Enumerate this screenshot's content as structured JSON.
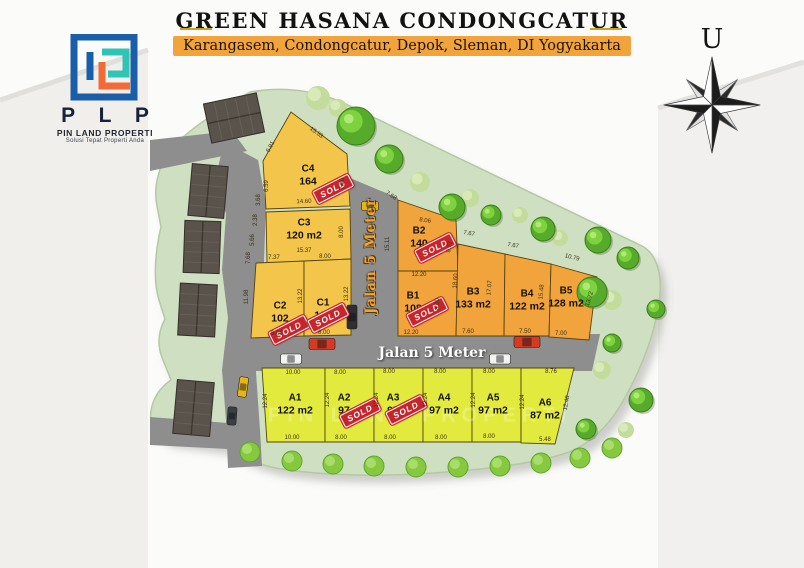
{
  "header": {
    "title": "GREEN HASANA CONDONGCATUR",
    "subtitle": "Karangasem, Condongcatur, Depok, Sleman, DI Yogyakarta"
  },
  "logo": {
    "acronym": "P L P",
    "company": "PIN LAND PROPERTI",
    "tagline": "Solusi Tepat Properti Anda"
  },
  "compass": {
    "north_label": "U"
  },
  "roads": {
    "horizontal_label": "Jalan 5 Meter",
    "vertical_label": "Jalan 5 Meter"
  },
  "labels": {
    "sold": "SOLD",
    "watermark": "PIN LAND PROPERTI"
  },
  "colors": {
    "accent_gold": "#c9a227",
    "subtitle_bg": "#f2a43c",
    "sold_red": "#c8242b",
    "road_gray": "#8e8e8e",
    "site_green": "#cfe0c2",
    "groups": {
      "A": "#e2eb3d",
      "B": "#f2a43c",
      "C": "#f3c64b"
    }
  },
  "siteplan": {
    "plots": [
      {
        "id": "C4",
        "group": "C",
        "area": "164",
        "sold": true,
        "points": "266,209 263,161 291,112 347,154 350,206",
        "label": {
          "x": 308,
          "y": 176
        },
        "stamp": {
          "x": 333,
          "y": 189
        }
      },
      {
        "id": "C3",
        "group": "C",
        "area": "120 m2",
        "sold": false,
        "points": "266,212 350,209 351,259 267,263",
        "label": {
          "x": 304,
          "y": 230
        }
      },
      {
        "id": "C2",
        "group": "C",
        "area": "102",
        "sold": true,
        "points": "256,263 304,261 304,336 251,338",
        "label": {
          "x": 280,
          "y": 313
        },
        "stamp": {
          "x": 289,
          "y": 330
        }
      },
      {
        "id": "C1",
        "group": "C",
        "area": "105",
        "sold": true,
        "points": "304,261 351,259 351,335 304,336",
        "label": {
          "x": 323,
          "y": 310
        },
        "stamp": {
          "x": 328,
          "y": 318
        }
      },
      {
        "id": "B2",
        "group": "B",
        "area": "140",
        "sold": true,
        "points": "398,200 456,220 458,271 398,271",
        "label": {
          "x": 419,
          "y": 238
        },
        "stamp": {
          "x": 435,
          "y": 248
        }
      },
      {
        "id": "B1",
        "group": "B",
        "area": "108",
        "sold": true,
        "points": "398,271 458,271 456,336 398,336",
        "label": {
          "x": 413,
          "y": 303
        },
        "stamp": {
          "x": 427,
          "y": 312
        }
      },
      {
        "id": "B3",
        "group": "B",
        "area": "133 m2",
        "sold": false,
        "points": "458,244 505,254 504,336 456,336",
        "label": {
          "x": 473,
          "y": 299
        }
      },
      {
        "id": "B4",
        "group": "B",
        "area": "122 m2",
        "sold": false,
        "points": "505,254 551,264 549,336 504,336",
        "label": {
          "x": 527,
          "y": 301
        }
      },
      {
        "id": "B5",
        "group": "B",
        "area": "128 m2",
        "sold": false,
        "points": "551,264 597,277 589,340 549,337",
        "label": {
          "x": 566,
          "y": 298
        }
      },
      {
        "id": "A1",
        "group": "A",
        "area": "122 m2",
        "sold": false,
        "points": "262,368 325,368 325,442 267,442",
        "label": {
          "x": 295,
          "y": 405
        }
      },
      {
        "id": "A2",
        "group": "A",
        "area": "97",
        "sold": true,
        "points": "325,368 374,368 374,442 325,442",
        "label": {
          "x": 344,
          "y": 405
        },
        "stamp": {
          "x": 360,
          "y": 413
        }
      },
      {
        "id": "A3",
        "group": "A",
        "area": "97",
        "sold": true,
        "points": "374,368 423,368 423,442 374,442",
        "label": {
          "x": 393,
          "y": 405
        },
        "stamp": {
          "x": 406,
          "y": 410
        }
      },
      {
        "id": "A4",
        "group": "A",
        "area": "97 m2",
        "sold": false,
        "points": "423,368 472,368 472,442 423,442",
        "label": {
          "x": 444,
          "y": 405
        }
      },
      {
        "id": "A5",
        "group": "A",
        "area": "97 m2",
        "sold": false,
        "points": "472,368 521,368 521,442 472,442",
        "label": {
          "x": 493,
          "y": 405
        }
      },
      {
        "id": "A6",
        "group": "A",
        "area": "87 m2",
        "sold": false,
        "points": "521,368 574,368 555,444 521,443",
        "label": {
          "x": 545,
          "y": 410
        }
      }
    ],
    "dimensions": [
      {
        "v": "6.91",
        "x": 271,
        "y": 147,
        "r": -62
      },
      {
        "v": "15.33",
        "x": 316,
        "y": 133,
        "r": 36
      },
      {
        "v": "6.59",
        "x": 267,
        "y": 186,
        "r": -90
      },
      {
        "v": "7.00",
        "x": 343,
        "y": 184,
        "r": -90
      },
      {
        "v": "14.60",
        "x": 304,
        "y": 202,
        "r": -2
      },
      {
        "v": "3.68",
        "x": 259,
        "y": 200,
        "r": -90
      },
      {
        "v": "2.38",
        "x": 256,
        "y": 220,
        "r": -90
      },
      {
        "v": "5.66",
        "x": 253,
        "y": 240,
        "r": -90
      },
      {
        "v": "7.68",
        "x": 249,
        "y": 258,
        "r": -90
      },
      {
        "v": "8.00",
        "x": 342,
        "y": 232,
        "r": -90
      },
      {
        "v": "15.37",
        "x": 304,
        "y": 251,
        "r": 0
      },
      {
        "v": "7.37",
        "x": 274,
        "y": 258,
        "r": 0
      },
      {
        "v": "8.00",
        "x": 325,
        "y": 257,
        "r": 0
      },
      {
        "v": "13.22",
        "x": 301,
        "y": 296,
        "r": -90
      },
      {
        "v": "13.22",
        "x": 347,
        "y": 294,
        "r": -90
      },
      {
        "v": "11.98",
        "x": 247,
        "y": 297,
        "r": -90
      },
      {
        "v": "8.00",
        "x": 277,
        "y": 334,
        "r": 0
      },
      {
        "v": "8.00",
        "x": 324,
        "y": 333,
        "r": 0
      },
      {
        "v": "7.68",
        "x": 391,
        "y": 196,
        "r": 33
      },
      {
        "v": "15.11",
        "x": 388,
        "y": 244,
        "r": -90
      },
      {
        "v": "8.06",
        "x": 425,
        "y": 221,
        "r": 8
      },
      {
        "v": "9.77",
        "x": 450,
        "y": 247,
        "r": -80
      },
      {
        "v": "12.20",
        "x": 419,
        "y": 275,
        "r": 0
      },
      {
        "v": "7.67",
        "x": 469,
        "y": 234,
        "r": 10
      },
      {
        "v": "7.67",
        "x": 513,
        "y": 246,
        "r": 10
      },
      {
        "v": "10.79",
        "x": 572,
        "y": 258,
        "r": 14
      },
      {
        "v": "18.60",
        "x": 456,
        "y": 281,
        "r": -85
      },
      {
        "v": "17.07",
        "x": 490,
        "y": 288,
        "r": -85
      },
      {
        "v": "15.48",
        "x": 542,
        "y": 292,
        "r": -85
      },
      {
        "v": "13.72",
        "x": 590,
        "y": 299,
        "r": -73
      },
      {
        "v": "8.00",
        "x": 438,
        "y": 304,
        "r": -90
      },
      {
        "v": "12.20",
        "x": 411,
        "y": 333,
        "r": 0
      },
      {
        "v": "7.60",
        "x": 468,
        "y": 332,
        "r": 0
      },
      {
        "v": "7.50",
        "x": 525,
        "y": 332,
        "r": 0
      },
      {
        "v": "7.00",
        "x": 561,
        "y": 334,
        "r": 0
      },
      {
        "v": "10.00",
        "x": 293,
        "y": 373,
        "r": 0
      },
      {
        "v": "8.00",
        "x": 340,
        "y": 373,
        "r": 0
      },
      {
        "v": "8.00",
        "x": 389,
        "y": 372,
        "r": 0
      },
      {
        "v": "8.00",
        "x": 440,
        "y": 372,
        "r": 0
      },
      {
        "v": "8.00",
        "x": 489,
        "y": 372,
        "r": 0
      },
      {
        "v": "8.76",
        "x": 551,
        "y": 372,
        "r": 0
      },
      {
        "v": "12.24",
        "x": 266,
        "y": 401,
        "r": -90
      },
      {
        "v": "12.24",
        "x": 328,
        "y": 400,
        "r": -90
      },
      {
        "v": "12.24",
        "x": 377,
        "y": 400,
        "r": -90
      },
      {
        "v": "12.24",
        "x": 426,
        "y": 400,
        "r": -90
      },
      {
        "v": "12.24",
        "x": 474,
        "y": 400,
        "r": -90
      },
      {
        "v": "12.24",
        "x": 523,
        "y": 402,
        "r": -90
      },
      {
        "v": "12.48",
        "x": 567,
        "y": 403,
        "r": -80
      },
      {
        "v": "10.00",
        "x": 292,
        "y": 438,
        "r": 0
      },
      {
        "v": "8.00",
        "x": 341,
        "y": 438,
        "r": 0
      },
      {
        "v": "8.00",
        "x": 390,
        "y": 438,
        "r": 0
      },
      {
        "v": "8.00",
        "x": 441,
        "y": 438,
        "r": 0
      },
      {
        "v": "8.00",
        "x": 489,
        "y": 437,
        "r": 0
      },
      {
        "v": "5.48",
        "x": 545,
        "y": 440,
        "r": 0
      }
    ]
  }
}
